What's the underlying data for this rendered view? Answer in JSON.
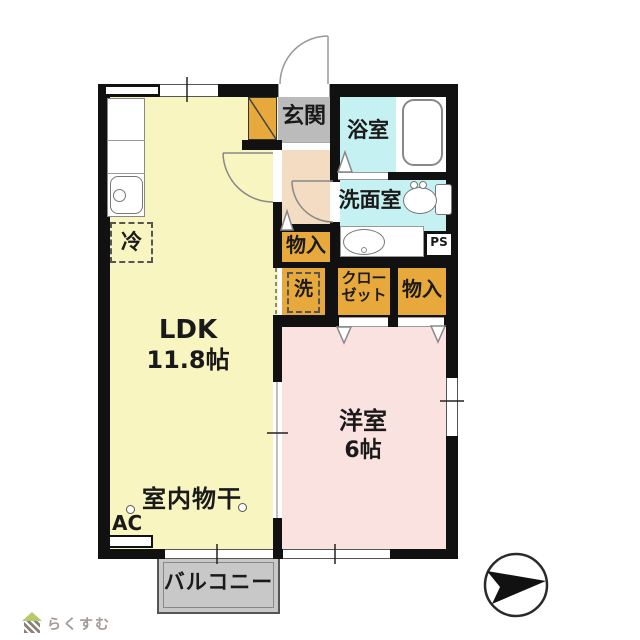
{
  "plan": {
    "ldk": {
      "name": "LDK",
      "size": "11.8帖"
    },
    "western_room": {
      "name": "洋室",
      "size": "6帖"
    },
    "entrance": {
      "name": "玄関"
    },
    "bathroom": {
      "name": "浴室"
    },
    "washroom": {
      "name": "洗面室"
    },
    "storage_hall": {
      "name": "物入"
    },
    "washer_space": {
      "name": "洗"
    },
    "closet": {
      "name": "クローゼット",
      "line1": "クロー",
      "line2": "ゼット"
    },
    "storage_bedroom": {
      "name": "物入"
    },
    "pipe_space": {
      "name": "PS"
    },
    "balcony": {
      "name": "バルコニー"
    },
    "indoor_drying": {
      "name": "室内物干"
    },
    "ac": {
      "name": "AC"
    },
    "refrigerator": {
      "name": "冷"
    }
  },
  "branding": {
    "logo_text": "らくすむ"
  },
  "colors": {
    "ldk_fill": "#F8F5C0",
    "western_room_fill": "#FAE2E1",
    "hallway_fill": "#F3DCC2",
    "wet_area_fill": "#C6F1F2",
    "storage_fill": "#E8A93C",
    "entrance_fill": "#BBBBBB",
    "balcony_fill": "#C8C8C8",
    "wall": "#111111"
  }
}
